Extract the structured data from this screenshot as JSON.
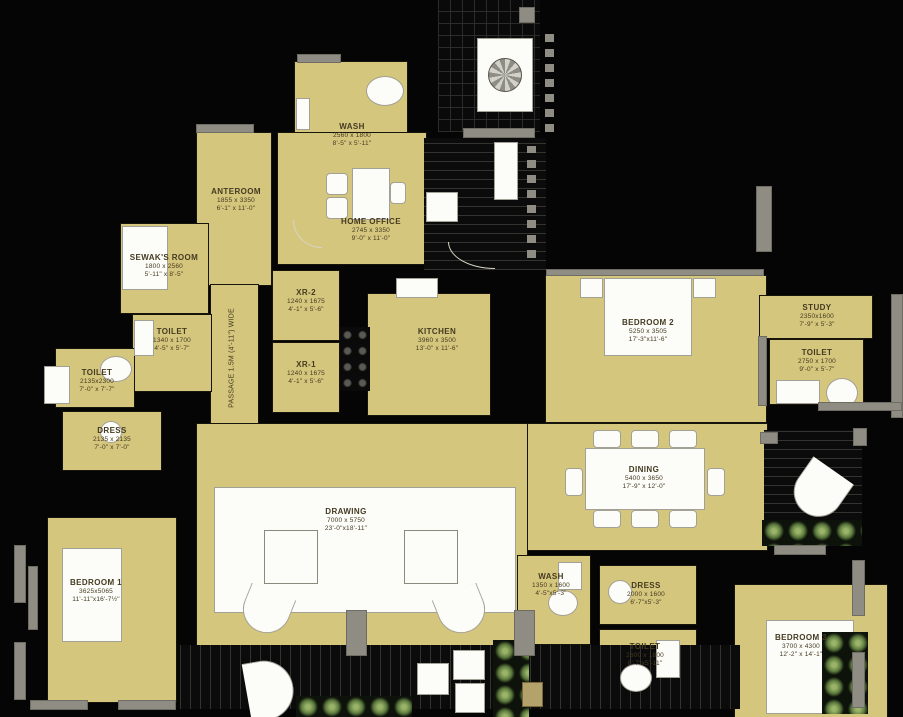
{
  "meta": {
    "colors": {
      "background": "#050505",
      "room_fill": "#d5c67d",
      "wall_gray": "#8f8d83",
      "plant_green": "#6f8c49",
      "label_text": "#443a21",
      "furniture_white": "#fcfcf8"
    }
  },
  "passage": {
    "label": "PASSAGE 1.5M (4'-11\") WIDE"
  },
  "rooms": {
    "wash_top": {
      "name": "WASH",
      "mm": "2560 x 1800",
      "ft": "8'-5\" x 5'-11\""
    },
    "anteroom": {
      "name": "ANTEROOM",
      "mm": "1855 x 3350",
      "ft": "6'-1\" x 11'-0\""
    },
    "home_office": {
      "name": "HOME OFFICE",
      "mm": "2745 x 3350",
      "ft": "9'-0\" x 11'-0\""
    },
    "sewak": {
      "name": "SEWAK'S ROOM",
      "mm": "1800 x 2560",
      "ft": "5'-11\" x 8'-5\""
    },
    "toilet_a": {
      "name": "TOILET",
      "mm": "1340 x 1700",
      "ft": "4'-5\" x 5'-7\""
    },
    "toilet_b": {
      "name": "TOILET",
      "mm": "2135x2300",
      "ft": "7'-0\" x 7'-7\""
    },
    "dress_a": {
      "name": "DRESS",
      "mm": "2135 x 2135",
      "ft": "7'-0\" x 7'-0\""
    },
    "xr2": {
      "name": "XR-2",
      "mm": "1240 x 1675",
      "ft": "4'-1\" x 5'-6\""
    },
    "xr1": {
      "name": "XR-1",
      "mm": "1240 x 1675",
      "ft": "4'-1\" x 5'-6\""
    },
    "kitchen": {
      "name": "KITCHEN",
      "mm": "3960 x 3500",
      "ft": "13'-0\" x 11'-6\""
    },
    "bedroom2": {
      "name": "BEDROOM 2",
      "mm": "5250 x 3505",
      "ft": "17'-3\"x11'-6\""
    },
    "study": {
      "name": "STUDY",
      "mm": "2350x1600",
      "ft": "7'-9\" x 5'-3\""
    },
    "toilet_c": {
      "name": "TOILET",
      "mm": "2750 x 1700",
      "ft": "9'-0\" x 5'-7\""
    },
    "dining": {
      "name": "DINING",
      "mm": "5400 x 3650",
      "ft": "17'-9\" x 12'-0\""
    },
    "drawing": {
      "name": "DRAWING",
      "mm": "7000 x 5750",
      "ft": "23'-0\"x18'-11\""
    },
    "bedroom1": {
      "name": "BEDROOM 1",
      "mm": "3625x5065",
      "ft": "11'-11\"x16'-7½\""
    },
    "wash_b": {
      "name": "WASH",
      "mm": "1350 x 1600",
      "ft": "4'-5\"x5'-3\""
    },
    "dress_b": {
      "name": "DRESS",
      "mm": "2000 x 1600",
      "ft": "6'-7\"x5'-3\""
    },
    "toilet_d": {
      "name": "TOILET",
      "mm": "2600 x 1800",
      "ft": "8'-7\"x5'-11\""
    },
    "bedroom3": {
      "name": "BEDROOM 3",
      "mm": "3700 x 4300",
      "ft": "12'-2\" x 14'-1\""
    }
  }
}
